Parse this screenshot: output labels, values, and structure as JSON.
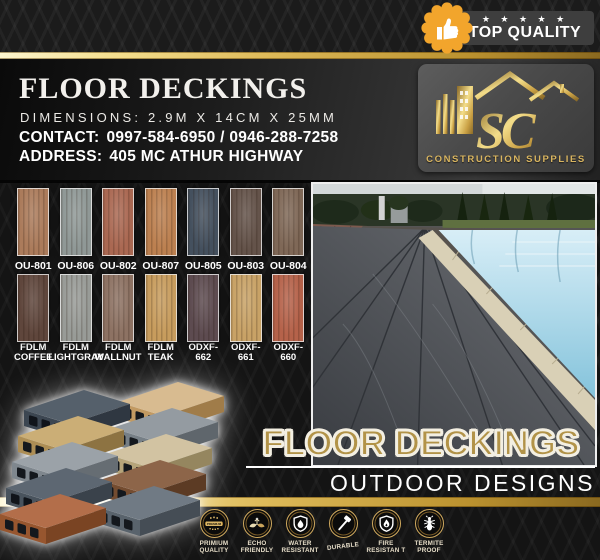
{
  "top_badge": {
    "stars": "★ ★ ★ ★ ★",
    "label": "TOP QUALITY"
  },
  "header": {
    "title": "FLOOR DECKINGS",
    "dimensions": "DIMENSIONS: 2.9M X 14CM X 25MM",
    "contact_label": "CONTACT:",
    "contact_value": "0997-584-6950 / 0946-288-7258",
    "address_label": "ADDRESS:",
    "address_value": "405 MC ATHUR HIGHWAY"
  },
  "logo": {
    "monogram": "SC",
    "company": "CONSTRUCTION SUPPLIES"
  },
  "swatches": {
    "row1": [
      {
        "label": "OU-801",
        "color": "#ab7b5b"
      },
      {
        "label": "OU-806",
        "color": "#8f9896"
      },
      {
        "label": "OU-802",
        "color": "#aa6852"
      },
      {
        "label": "OU-807",
        "color": "#bc8050"
      },
      {
        "label": "OU-805",
        "color": "#44505e"
      },
      {
        "label": "OU-803",
        "color": "#64534a"
      },
      {
        "label": "OU-804",
        "color": "#7f6857"
      }
    ],
    "row2": [
      {
        "line1": "FDLM",
        "line2": "COFFEE",
        "color": "#5f463c"
      },
      {
        "line1": "FDLM",
        "line2": "LIGHTGRAY",
        "color": "#989b97"
      },
      {
        "line1": "FDLM",
        "line2": "WALLNUT",
        "color": "#8d7263"
      },
      {
        "line1": "FDLM",
        "line2": "TEAK",
        "color": "#c79c5d"
      },
      {
        "line1": "ODXF-",
        "line2": "662",
        "color": "#5d4b50"
      },
      {
        "line1": "ODXF-",
        "line2": "661",
        "color": "#c8a266"
      },
      {
        "line1": "ODXF-",
        "line2": "660",
        "color": "#b5624a"
      }
    ]
  },
  "promo": {
    "headline": "FLOOR DECKINGS",
    "subheadline": "OUTDOOR DESIGNS"
  },
  "features": [
    {
      "name": "premium-quality",
      "line1": "PRIMIUM",
      "line2": "QUALITY",
      "seal_text": "PREMIUM"
    },
    {
      "name": "eco-friendly",
      "line1": "ECHO",
      "line2": "FRIENDLY"
    },
    {
      "name": "water-resistant",
      "line1": "WATER",
      "line2": "RESISTANT"
    },
    {
      "name": "durable",
      "line1": "DURABLE",
      "line2": ""
    },
    {
      "name": "fire-resistant",
      "line1": "FIRE",
      "line2": "RESISTAN T"
    },
    {
      "name": "termite-proof",
      "line1": "TERMITE",
      "line2": "PROOF"
    }
  ],
  "colors": {
    "gold_accent": "#cfa95e",
    "seal_orange": "#f2a52c",
    "banner_gray": "#3e3e3e",
    "headline_gold": "#b29348",
    "stripe_gold": "#ddb958"
  }
}
